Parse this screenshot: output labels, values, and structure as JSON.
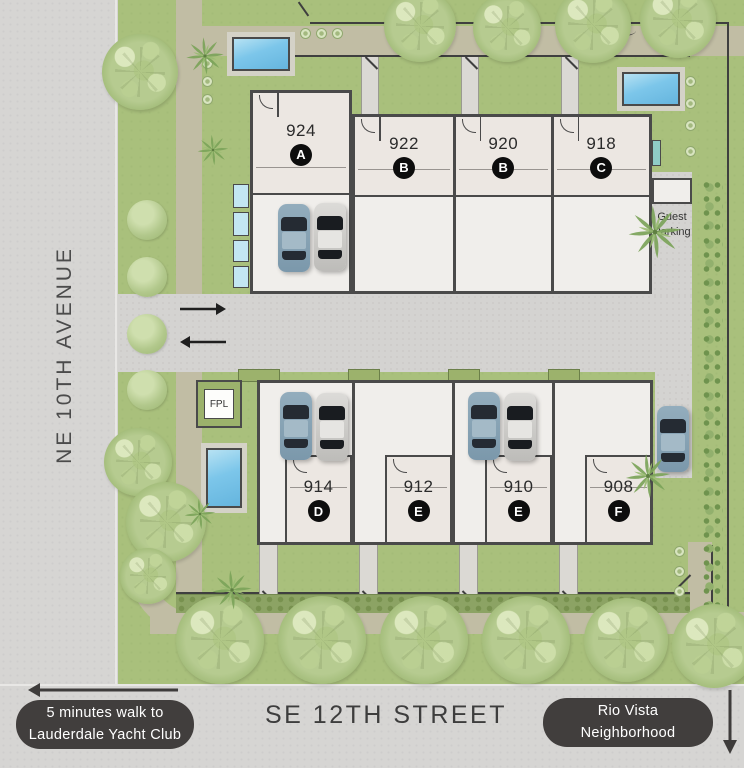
{
  "streets": {
    "left": "NE 10TH AVENUE",
    "bottom": "SE 12TH STREET"
  },
  "callouts": {
    "yacht": {
      "line1": "5 minutes walk to",
      "line2": "Lauderdale Yacht Club"
    },
    "rio": {
      "line1": "Rio Vista",
      "line2": "Neighborhood"
    }
  },
  "labels": {
    "guest1": "Guest",
    "guest2": "Parking",
    "fpl": "FPL"
  },
  "units_top": [
    {
      "number": "924",
      "letter": "A"
    },
    {
      "number": "922",
      "letter": "B"
    },
    {
      "number": "920",
      "letter": "B"
    },
    {
      "number": "918",
      "letter": "C"
    }
  ],
  "units_bottom": [
    {
      "number": "914",
      "letter": "D"
    },
    {
      "number": "912",
      "letter": "E"
    },
    {
      "number": "910",
      "letter": "E"
    },
    {
      "number": "908",
      "letter": "F"
    }
  ],
  "icons": {
    "entry_in": "right-arrow-icon",
    "entry_out": "left-arrow-icon",
    "yacht_direction": "left-arrow-icon",
    "rio_direction": "down-arrow-icon",
    "landscape": [
      "canopy-tree-icon",
      "bush-icon",
      "palm-tree-icon",
      "flower-bush-icon"
    ],
    "objects": [
      "pool",
      "car"
    ]
  },
  "colors": {
    "street": "#d6d5d3",
    "grass": "#a9c07c",
    "walkway": "#c1bda4",
    "building_wall": "#4a4a4a",
    "unit_room": "#ece7e2",
    "garage_slab": "#f0eeeb",
    "pool_water": "#7cc6ea",
    "unit_badge": "#0d0d0d",
    "callout_bg": "#413e3d",
    "hedge": "#8ca364"
  }
}
